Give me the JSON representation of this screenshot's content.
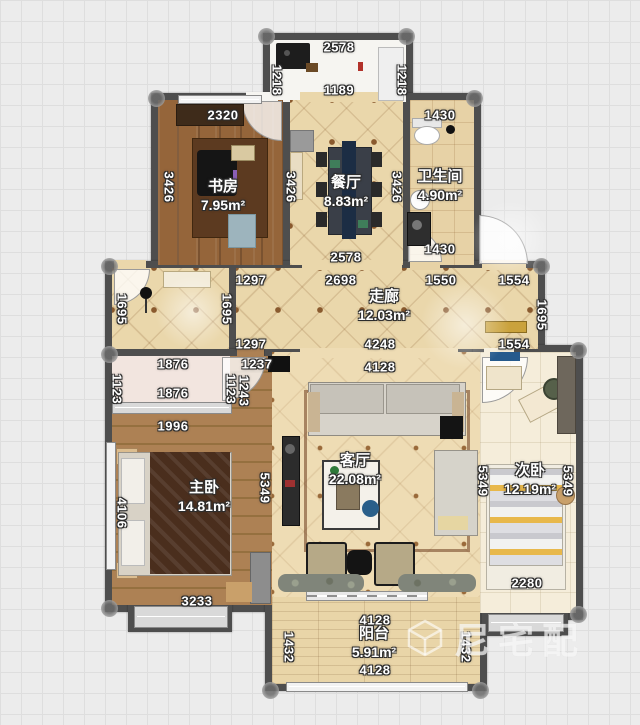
{
  "plan_title": "residential-floorplan",
  "rooms": {
    "study": {
      "name": "书房",
      "area": "7.95m²"
    },
    "dining": {
      "name": "餐厅",
      "area": "8.83m²"
    },
    "bath": {
      "name": "卫生间",
      "area": "4.90m²"
    },
    "corridor": {
      "name": "走廊",
      "area": "12.03m²"
    },
    "master": {
      "name": "主卧",
      "area": "14.81m²"
    },
    "living": {
      "name": "客厅",
      "area": "22.08m²"
    },
    "second": {
      "name": "次卧",
      "area": "12.19m²"
    },
    "balcony": {
      "name": "阳台",
      "area": "5.91m²"
    }
  },
  "watermark": {
    "text": "尼宅配",
    "logo": "cube-logo"
  },
  "colors": {
    "wall": "#4e4e4e",
    "grid_bg": "#ececec",
    "quilt_floor": "#ead7ab",
    "wood_floor": "#8d5f36",
    "master_wood": "#a87c50",
    "label_text": "#ffffff",
    "label_outline": "#2c2c2c"
  },
  "dimensions_mm": [
    {
      "value": "2578",
      "x": 339,
      "y": 47,
      "v": false
    },
    {
      "value": "1218",
      "x": 277,
      "y": 80,
      "v": true
    },
    {
      "value": "1218",
      "x": 402,
      "y": 80,
      "v": true
    },
    {
      "value": "1189",
      "x": 339,
      "y": 90,
      "v": false
    },
    {
      "value": "2320",
      "x": 223,
      "y": 115,
      "v": false
    },
    {
      "value": "1430",
      "x": 440,
      "y": 115,
      "v": false
    },
    {
      "value": "3426",
      "x": 169,
      "y": 187,
      "v": true
    },
    {
      "value": "3426",
      "x": 291,
      "y": 187,
      "v": true
    },
    {
      "value": "3426",
      "x": 397,
      "y": 187,
      "v": true
    },
    {
      "value": "2578",
      "x": 346,
      "y": 257,
      "v": false
    },
    {
      "value": "1430",
      "x": 440,
      "y": 249,
      "v": false
    },
    {
      "value": "1297",
      "x": 251,
      "y": 280,
      "v": false
    },
    {
      "value": "2698",
      "x": 341,
      "y": 280,
      "v": false
    },
    {
      "value": "1550",
      "x": 441,
      "y": 280,
      "v": false
    },
    {
      "value": "1554",
      "x": 514,
      "y": 280,
      "v": false
    },
    {
      "value": "1695",
      "x": 122,
      "y": 309,
      "v": true
    },
    {
      "value": "1695",
      "x": 227,
      "y": 309,
      "v": true
    },
    {
      "value": "1695",
      "x": 542,
      "y": 315,
      "v": true
    },
    {
      "value": "1297",
      "x": 251,
      "y": 344,
      "v": false
    },
    {
      "value": "4248",
      "x": 380,
      "y": 344,
      "v": false
    },
    {
      "value": "1554",
      "x": 514,
      "y": 344,
      "v": false
    },
    {
      "value": "4128",
      "x": 380,
      "y": 367,
      "v": false
    },
    {
      "value": "1876",
      "x": 173,
      "y": 364,
      "v": false
    },
    {
      "value": "1237",
      "x": 257,
      "y": 364,
      "v": false
    },
    {
      "value": "1123",
      "x": 117,
      "y": 389,
      "v": true
    },
    {
      "value": "1123",
      "x": 231,
      "y": 389,
      "v": true
    },
    {
      "value": "1243",
      "x": 244,
      "y": 391,
      "v": true
    },
    {
      "value": "1876",
      "x": 173,
      "y": 393,
      "v": false
    },
    {
      "value": "1996",
      "x": 173,
      "y": 426,
      "v": false
    },
    {
      "value": "4106",
      "x": 122,
      "y": 513,
      "v": true
    },
    {
      "value": "5349",
      "x": 265,
      "y": 488,
      "v": true
    },
    {
      "value": "3233",
      "x": 197,
      "y": 601,
      "v": false
    },
    {
      "value": "5349",
      "x": 483,
      "y": 481,
      "v": true
    },
    {
      "value": "5349",
      "x": 568,
      "y": 481,
      "v": true
    },
    {
      "value": "2280",
      "x": 527,
      "y": 583,
      "v": false
    },
    {
      "value": "4128",
      "x": 375,
      "y": 620,
      "v": false
    },
    {
      "value": "1432",
      "x": 289,
      "y": 647,
      "v": true
    },
    {
      "value": "1432",
      "x": 466,
      "y": 647,
      "v": true
    },
    {
      "value": "4128",
      "x": 375,
      "y": 670,
      "v": false
    }
  ]
}
